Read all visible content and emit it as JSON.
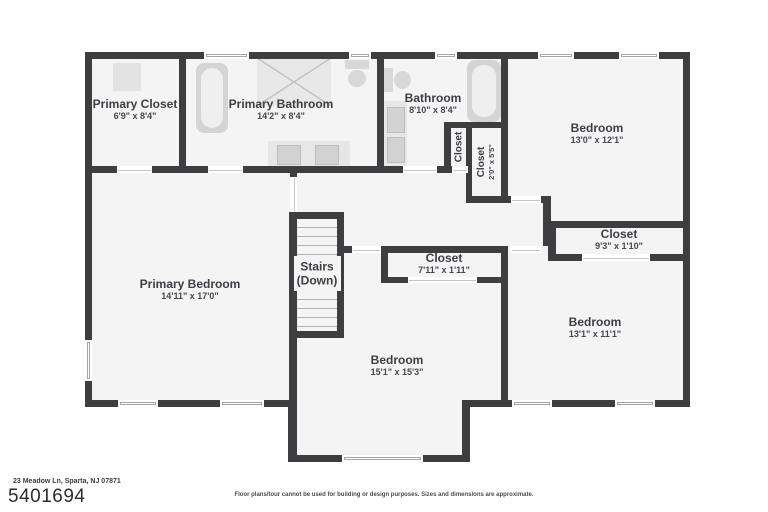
{
  "floorplan": {
    "rooms": [
      {
        "name": "Primary Closet",
        "dims": "6'9\" x 8'4\""
      },
      {
        "name": "Primary Bathroom",
        "dims": "14'2\" x 8'4\""
      },
      {
        "name": "Bathroom",
        "dims": "8'10\" x 8'4\""
      },
      {
        "name": "Closet",
        "dims": ""
      },
      {
        "name": "Closet",
        "dims": "2'0\" x 5'5\""
      },
      {
        "name": "Bedroom",
        "dims": "13'0\" x 12'1\""
      },
      {
        "name": "Closet",
        "dims": "9'3\" x 1'10\""
      },
      {
        "name": "Primary Bedroom",
        "dims": "14'11\" x 17'0\""
      },
      {
        "name": "Stairs",
        "dims": "(Down)"
      },
      {
        "name": "Closet",
        "dims": "7'11\" x 1'11\""
      },
      {
        "name": "Bedroom",
        "dims": "15'1\" x 15'3\""
      },
      {
        "name": "Bedroom",
        "dims": "13'1\" x 11'1\""
      }
    ],
    "footer": {
      "address": "23 Meadow Ln, Sparta, NJ 07871",
      "mls_number": "5401694",
      "disclaimer": "Floor plans/tour cannot be used for building or design purposes. Sizes and dimensions are approximate."
    },
    "colors": {
      "wall": "#3e3e40",
      "room_fill": "#f4f4f4",
      "fixture": "#d8d8d8",
      "text": "#3e3e44"
    }
  }
}
